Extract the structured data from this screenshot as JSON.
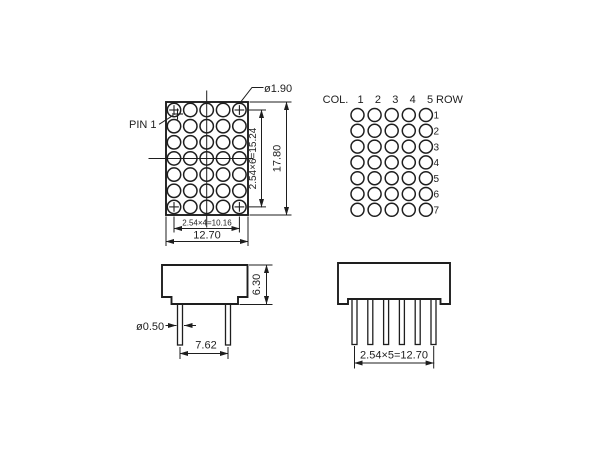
{
  "front_view": {
    "pin1_label": "PIN 1",
    "dot_diameter": "ø1.90",
    "vertical_pitch": "2.54×6=15.24",
    "overall_height": "17.80",
    "horizontal_pitch": "2.54×4=10.16",
    "overall_width": "12.70"
  },
  "pinout_view": {
    "col_header": "COL.",
    "row_header": "ROW",
    "col_numbers": [
      "1",
      "2",
      "3",
      "4",
      "5"
    ],
    "row_numbers": [
      "1",
      "2",
      "3",
      "4",
      "5",
      "6",
      "7"
    ]
  },
  "front_profile_view": {
    "body_height": "6.30",
    "pin_diameter": "ø0.50",
    "pin_span": "7.62",
    "pin_count": 2
  },
  "side_profile_view": {
    "pin_pitch": "2.54×5=12.70",
    "pin_count": 6
  },
  "colors": {
    "line": "#1e1e1e",
    "background": "#ffffff"
  }
}
